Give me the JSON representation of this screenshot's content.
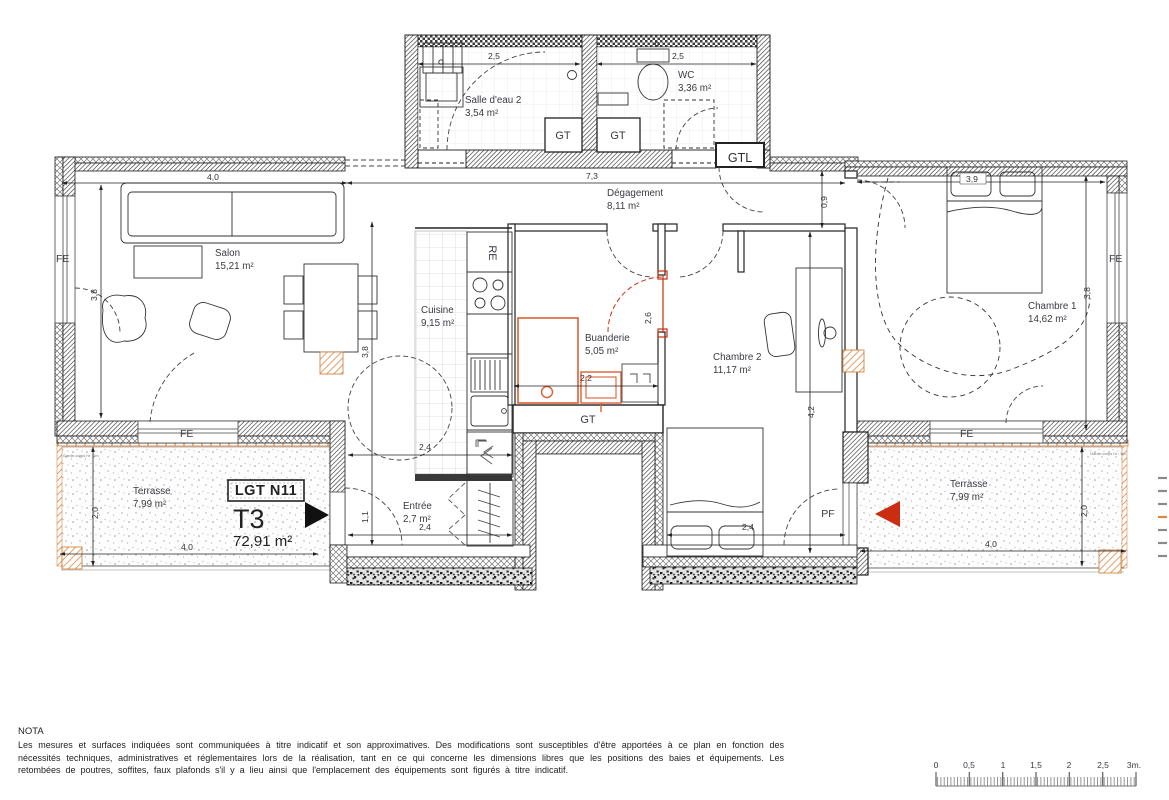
{
  "unit": {
    "lot": "LGT N11",
    "type": "T3",
    "area": "72,91 m²"
  },
  "rooms": {
    "salon": {
      "name": "Salon",
      "area": "15,21 m²"
    },
    "cuisine": {
      "name": "Cuisine",
      "area": "9,15 m²"
    },
    "buanderie": {
      "name": "Buanderie",
      "area": "5,05 m²"
    },
    "degagement": {
      "name": "Dégagement",
      "area": "8,11 m²"
    },
    "salle_eau": {
      "name": "Salle d'eau 2",
      "area": "3,54 m²"
    },
    "wc": {
      "name": "WC",
      "area": "3,36 m²"
    },
    "chambre1": {
      "name": "Chambre 1",
      "area": "14,62 m²"
    },
    "chambre2": {
      "name": "Chambre 2",
      "area": "11,17 m²"
    },
    "entree": {
      "name": "Entrée",
      "area": "2,7 m²"
    },
    "terrasse_l": {
      "name": "Terrasse",
      "area": "7,99 m²"
    },
    "terrasse_r": {
      "name": "Terrasse",
      "area": "7,99 m²"
    }
  },
  "dims": {
    "salon_w": "4,0",
    "degagement_w": "7,3",
    "salon_v": "3,8",
    "salon_aisle": "3,8",
    "sde2_w": "2,5",
    "wc_w": "2,5",
    "deg_v": "0,9",
    "buanderie_w": "2,2",
    "buanderie_door": "2,6",
    "ch2_v": "4,2",
    "ch2_w": "2,4",
    "ch1_w": "3,9",
    "ch1_v": "3,8",
    "entree_top": "2,4",
    "entree_v": "1,1",
    "entree_bottom": "2,4",
    "ter_l_v": "2,0",
    "ter_l_w": "4,0",
    "ter_r_v": "2,0",
    "ter_r_w": "4,0"
  },
  "tags": {
    "fe": "FE",
    "pf": "PF",
    "gt": "GT",
    "gtl": "GTL",
    "re": "RE",
    "garde": "Garde-corps ht : 1m"
  },
  "nota": {
    "title": "NOTA",
    "body": "Les mesures et surfaces indiquées sont communiquées à titre indicatif et son approximatives. Des modifications sont susceptibles d'être apportées à ce plan en fonction des nécessités techniques, administratives et réglementaires lors de la réalisation, tant en ce qui concerne les dimensions libres que les positions des baies et équipements. Les retombées de poutres, soffites, faux plafonds s'il y a lieu ainsi que l'emplacement des équipements sont figurés à titre indicatif."
  },
  "scale": {
    "labels": [
      "0",
      "0,5",
      "1",
      "1,5",
      "2",
      "2,5",
      "3m."
    ]
  },
  "colors": {
    "accent_orange": "#dd8743",
    "accent_red": "#cc2d10",
    "wall": "#2e2e2e"
  }
}
